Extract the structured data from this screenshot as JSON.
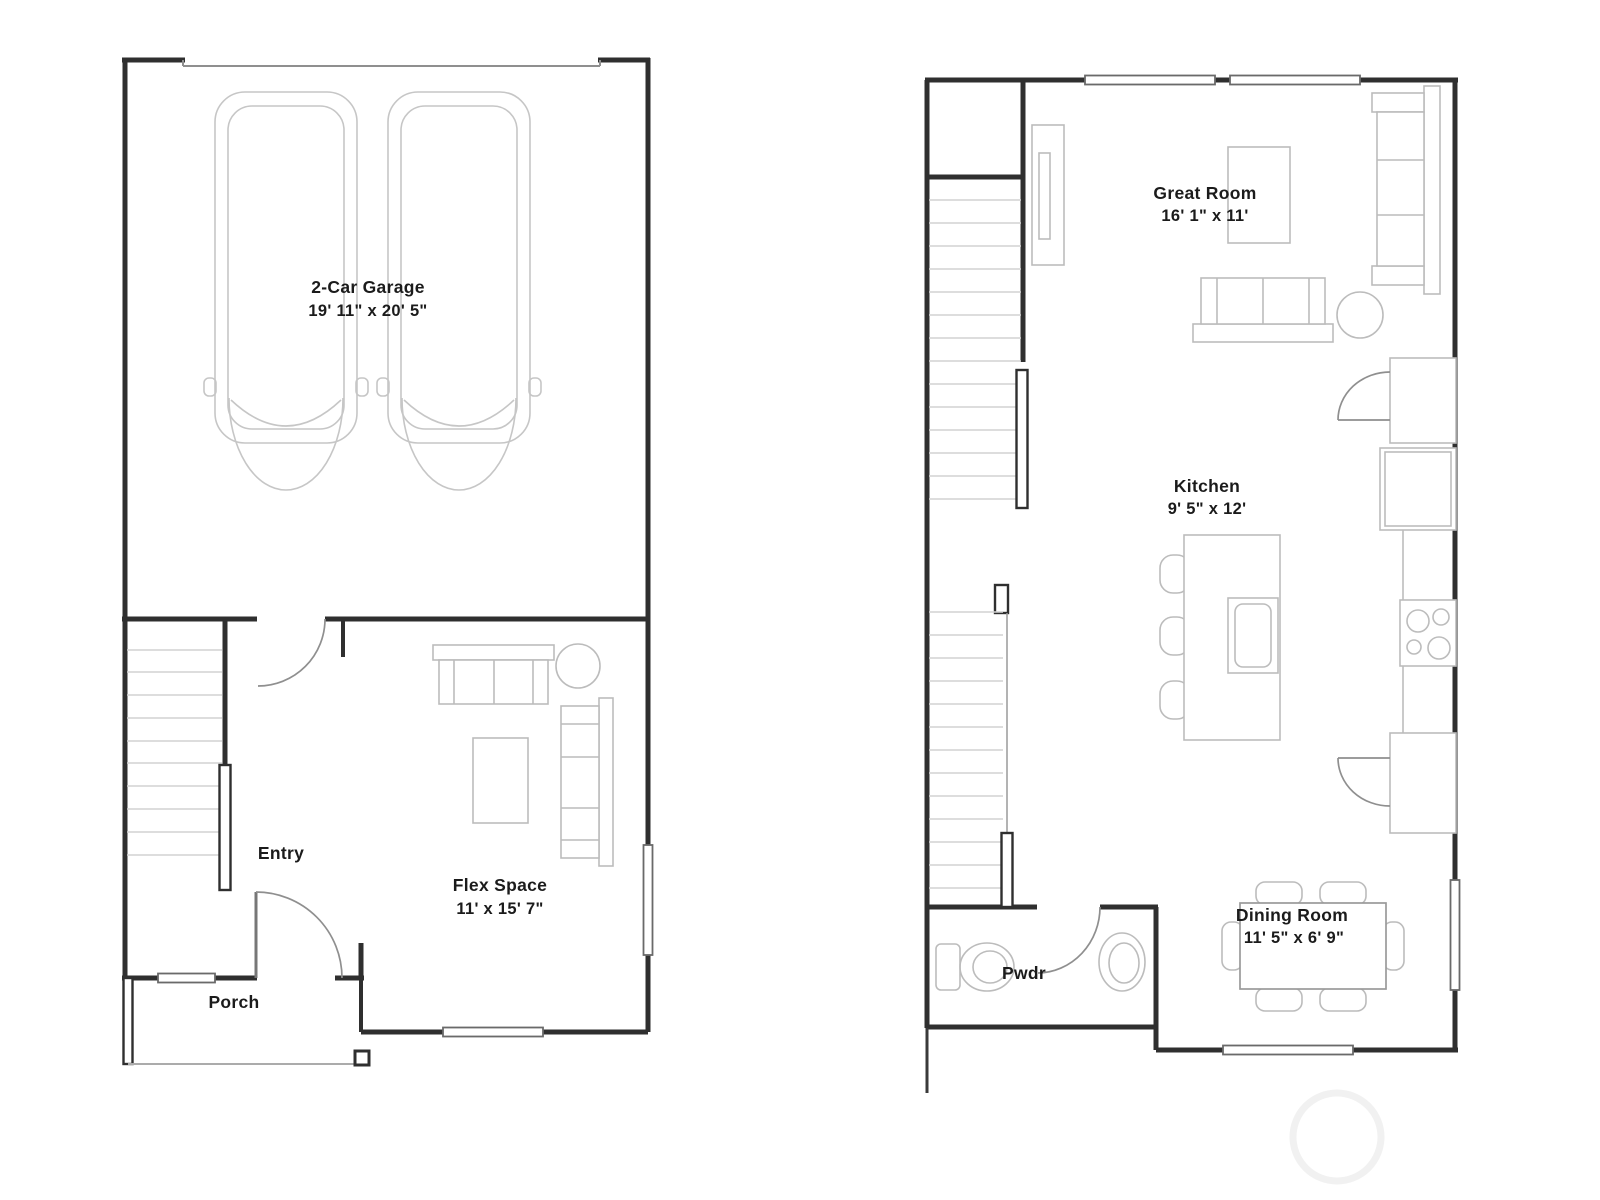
{
  "floor1": {
    "garage": {
      "name": "2-Car Garage",
      "dims": "19' 11\" x 20' 5\""
    },
    "entry": {
      "name": "Entry"
    },
    "flex": {
      "name": "Flex Space",
      "dims": "11' x 15' 7\""
    },
    "porch": {
      "name": "Porch"
    }
  },
  "floor2": {
    "great_room": {
      "name": "Great Room",
      "dims": "16' 1\" x 11'"
    },
    "kitchen": {
      "name": "Kitchen",
      "dims": "9' 5\" x 12'"
    },
    "dining": {
      "name": "Dining Room",
      "dims": "11' 5\" x 6' 9\""
    },
    "powder": {
      "name": "Pwdr"
    }
  },
  "colors": {
    "wall": "#2f2f2f",
    "furniture": "#bcbcbc",
    "stair_tread": "#d2d2d2",
    "door_arc": "#8f8f8f",
    "text": "#1b1b1b",
    "watermark": "#f1f1f1",
    "background": "#ffffff"
  }
}
